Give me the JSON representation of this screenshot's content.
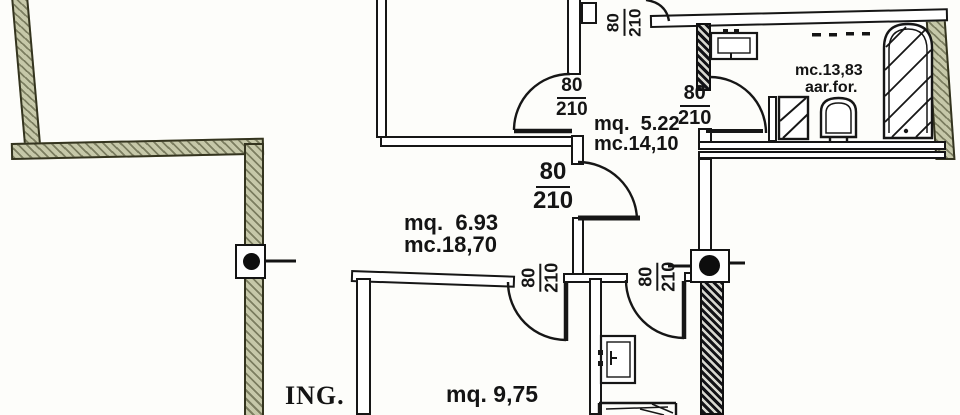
{
  "rooms": {
    "corridor": {
      "area": "mq.  5.22",
      "volume": "mc.14,10"
    },
    "mid": {
      "area": "mq.  6.93",
      "volume": "mc.18,70"
    },
    "bottom": {
      "area": "mq. 9,75"
    },
    "bath_top": {
      "volume": "mc.13,83",
      "vent_note": "aar.for."
    },
    "entrance": {
      "label": "ING."
    }
  },
  "doors": [
    {
      "width": "80",
      "height": "210"
    },
    {
      "width": "80",
      "height": "210"
    },
    {
      "width": "80",
      "height": "210"
    },
    {
      "width": "80",
      "height": "210"
    },
    {
      "width": "80",
      "height": "210"
    },
    {
      "width": "80",
      "height": "210"
    }
  ]
}
